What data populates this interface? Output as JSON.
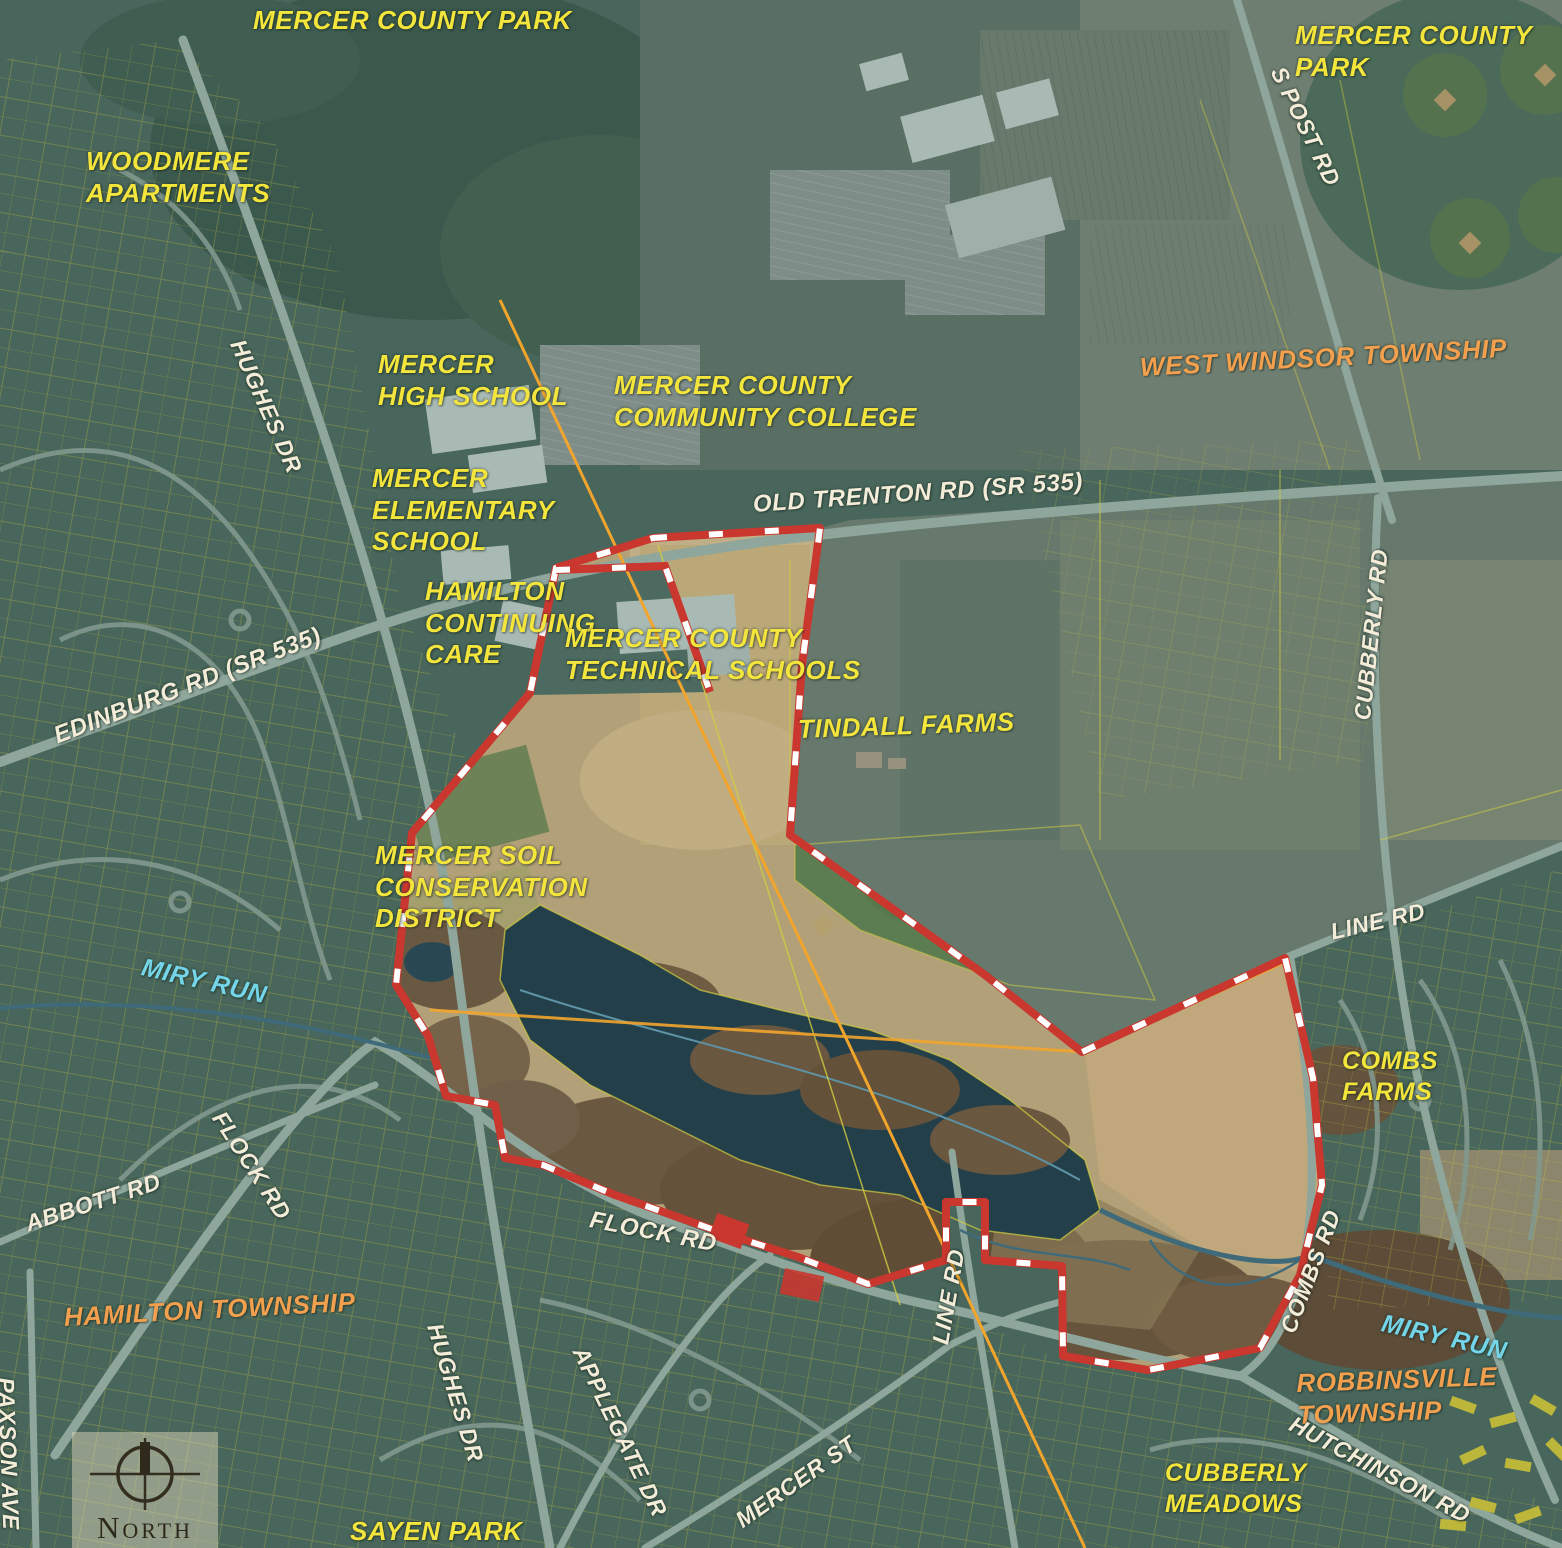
{
  "map_title": "Aerial study-area map of Mercer County park site and surroundings",
  "labels": {
    "parks": {
      "mercer_county_park": "MERCER COUNTY PARK",
      "sayen_park": "SAYEN PARK"
    },
    "places": {
      "woodmere_apartments": "WOODMERE\nAPARTMENTS",
      "mercer_high_school": "MERCER\nHIGH SCHOOL",
      "mercer_county_community_college": "MERCER COUNTY\nCOMMUNITY COLLEGE",
      "mercer_elementary_school": "MERCER\nELEMENTARY\nSCHOOL",
      "hamilton_continuing_care": "HAMILTON\nCONTINUING\nCARE",
      "mercer_county_technical_schools": "MERCER COUNTY\nTECHNICAL SCHOOLS",
      "tindall_farms": "TINDALL FARMS",
      "mercer_soil_conservation_district": "MERCER SOIL\nCONSERVATION\nDISTRICT",
      "combs_farms": "COMBS\nFARMS",
      "cubberly_meadows": "CUBBERLY\nMEADOWS"
    },
    "townships": {
      "west_windsor": "WEST WINDSOR TOWNSHIP",
      "hamilton": "HAMILTON TOWNSHIP",
      "robbinsville": "ROBBINSVILLE TOWNSHIP"
    },
    "roads": {
      "old_trenton_rd": "OLD TRENTON RD (SR 535)",
      "edinburg_rd": "EDINBURG RD (SR 535)",
      "s_post_rd": "S POST RD",
      "hughes_dr": "HUGHES DR",
      "cubberly_rd": "CUBBERLY RD",
      "line_rd": "LINE RD",
      "flock_rd": "FLOCK RD",
      "abbott_rd": "ABBOTT RD",
      "combs_rd": "COMBS RD",
      "paxson_ave": "PAXSON AVE",
      "applegate_dr": "APPLEGATE DR",
      "mercer_st": "MERCER ST",
      "hutchinson_rd": "HUTCHINSON RD"
    },
    "water": {
      "miry_run": "MIRY RUN"
    }
  },
  "compass": {
    "north": "NORTH"
  },
  "palette": {
    "label_yellow": "#f3e53c",
    "label_cream": "#f3ecd8",
    "label_cyan": "#74d5e8",
    "label_orange": "#f2a04e",
    "boundary_red": "#c9372f",
    "boundary_dash_white": "#ffffff",
    "parcel_line_yellow": "#cbc542",
    "utility_line_orange": "#f2a52c",
    "water_blue": "#3f6a7a",
    "road_gray_green": "#8ea69b",
    "base_teal_green": "#48665b",
    "study_area_tan": "#b2a078",
    "lake_dark": "#233f4a"
  }
}
